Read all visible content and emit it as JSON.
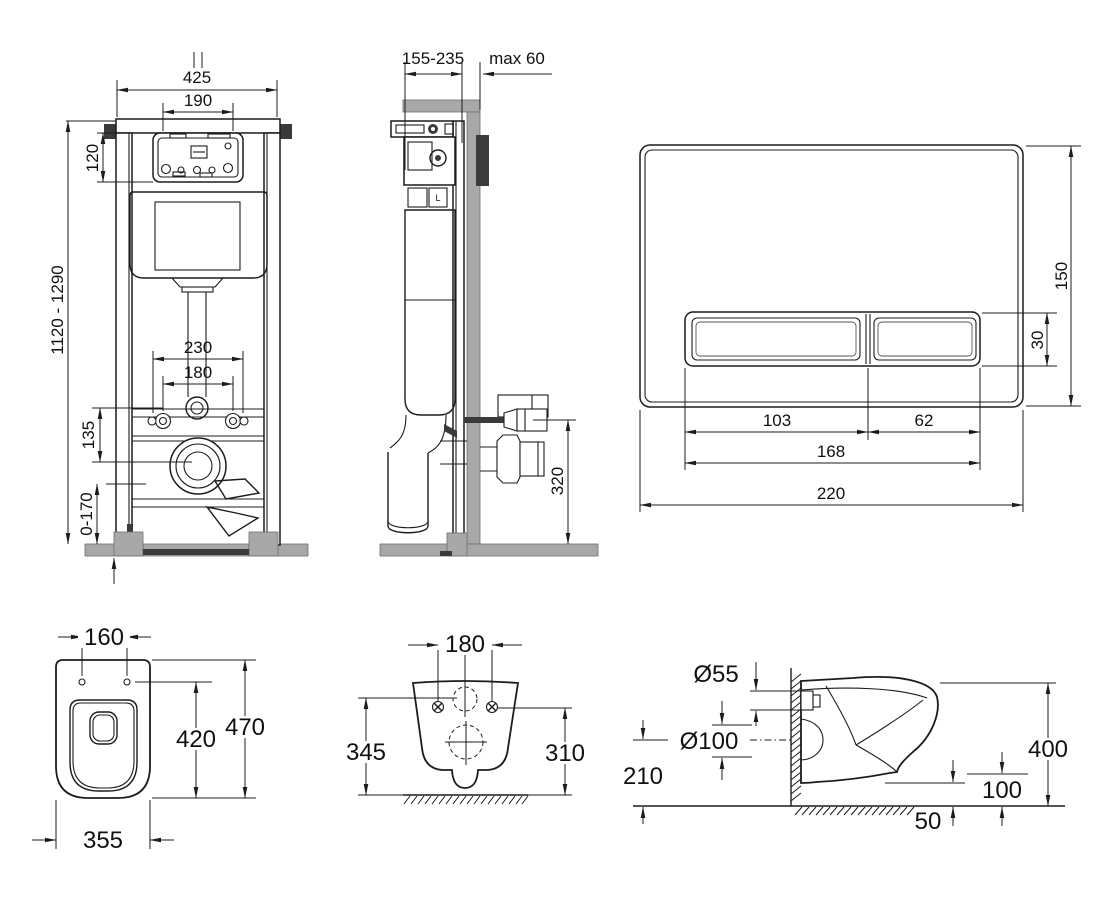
{
  "page": {
    "background": "#ffffff"
  },
  "colors": {
    "line": "#1c1c1c",
    "gray_fill": "#a8a8a8",
    "dark_fill": "#3a3a3a"
  },
  "labels": {
    "frame_front": {
      "total_width": "425",
      "panel_width": "190",
      "panel_height": "120",
      "frame_height": "1120 - 1290",
      "duct_spacing": "230",
      "bolt_spacing": "180",
      "inlet_offset": "135",
      "foot_range": "0-170"
    },
    "frame_side": {
      "depth_range": "155-235",
      "wall_max": "max 60",
      "outlet_height": "320",
      "valve_label": "L"
    },
    "flush_plate": {
      "height": "150",
      "button_height": "30",
      "big_button": "103",
      "small_button": "62",
      "buttons_total": "168",
      "width": "220"
    },
    "bowl_top": {
      "hole_spacing": "160",
      "length": "470",
      "hole_to_front": "420",
      "width": "355"
    },
    "bowl_rear": {
      "hole_spacing": "180",
      "left_height": "345",
      "right_height": "310"
    },
    "bowl_side": {
      "inlet_diameter": "Ø55",
      "drain_diameter": "Ø100",
      "drain_axis_height": "210",
      "depth": "400",
      "underside_height": "100",
      "underside_offset": "50"
    }
  }
}
